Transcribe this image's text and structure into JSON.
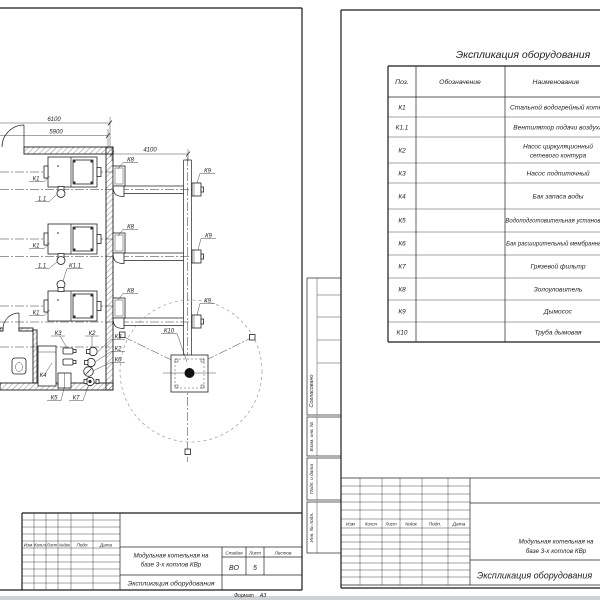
{
  "left_sheet": {
    "dims": {
      "top": "6100",
      "top2": "5900",
      "right": "4100"
    },
    "labels": {
      "k1": "К1",
      "fan": "1.1",
      "fan_full": "К1.1",
      "k2": "К2",
      "k3": "К3",
      "k4": "К4",
      "k5": "К5",
      "k6": "К6",
      "k7": "К7",
      "k8": "К8",
      "k9": "К9",
      "k10": "К10"
    },
    "title_block": {
      "cols": [
        "Изм",
        "Колич",
        "Лист",
        "№док",
        "Подп",
        "Дата"
      ],
      "project_l1": "Модульная котельная на",
      "project_l2": "базе 3-х котлов КВр",
      "doc_title": "Экспликация оборудования",
      "stage_label": "Стадия",
      "sheet_label": "Лист",
      "sheets_label": "Листов",
      "stage": "ВО",
      "sheet_no": "5",
      "sheets_total": "",
      "format_label": "Формат",
      "format_value": "А3"
    }
  },
  "right_sheet": {
    "table": {
      "title": "Экспликация оборудования",
      "col_pos": "Поз.",
      "col_code": "Обозначение",
      "col_name": "Наименование",
      "rows": [
        {
          "pos": "К1",
          "code": "",
          "name": "Стальной водогрейный котёл"
        },
        {
          "pos": "К1.1",
          "code": "",
          "name": "Вентилятор подачи воздуха"
        },
        {
          "pos": "К2",
          "code": "",
          "name": "Насос циркуляционный сетевого контура",
          "name_l1": "Насос циркуляционный",
          "name_l2": "сетевого контура"
        },
        {
          "pos": "К3",
          "code": "",
          "name": "Насос подпиточный"
        },
        {
          "pos": "К4",
          "code": "",
          "name": "Бак запаса воды"
        },
        {
          "pos": "К5",
          "code": "",
          "name": "Водоподготовительная установка"
        },
        {
          "pos": "К6",
          "code": "",
          "name": "Бак расширительный мембранный"
        },
        {
          "pos": "К7",
          "code": "",
          "name": "Грязевой фильтр"
        },
        {
          "pos": "К8",
          "code": "",
          "name": "Золоуловитель"
        },
        {
          "pos": "К9",
          "code": "",
          "name": "Дымосос"
        },
        {
          "pos": "К10",
          "code": "",
          "name": "Труба дымовая"
        }
      ]
    },
    "margin": {
      "approved": "Согласовано",
      "vzam": "Взам. инв. №",
      "podp": "Подп. и дата",
      "inv": "Инв. № подл."
    },
    "title_block": {
      "cols": [
        "Изм",
        "Колич",
        "Лист",
        "№док",
        "Подп.",
        "Дата"
      ],
      "project_l1": "Модульная котельная на",
      "project_l2": "базе 3-х котлов КВр",
      "doc_title": "Экспликация оборудования"
    }
  }
}
